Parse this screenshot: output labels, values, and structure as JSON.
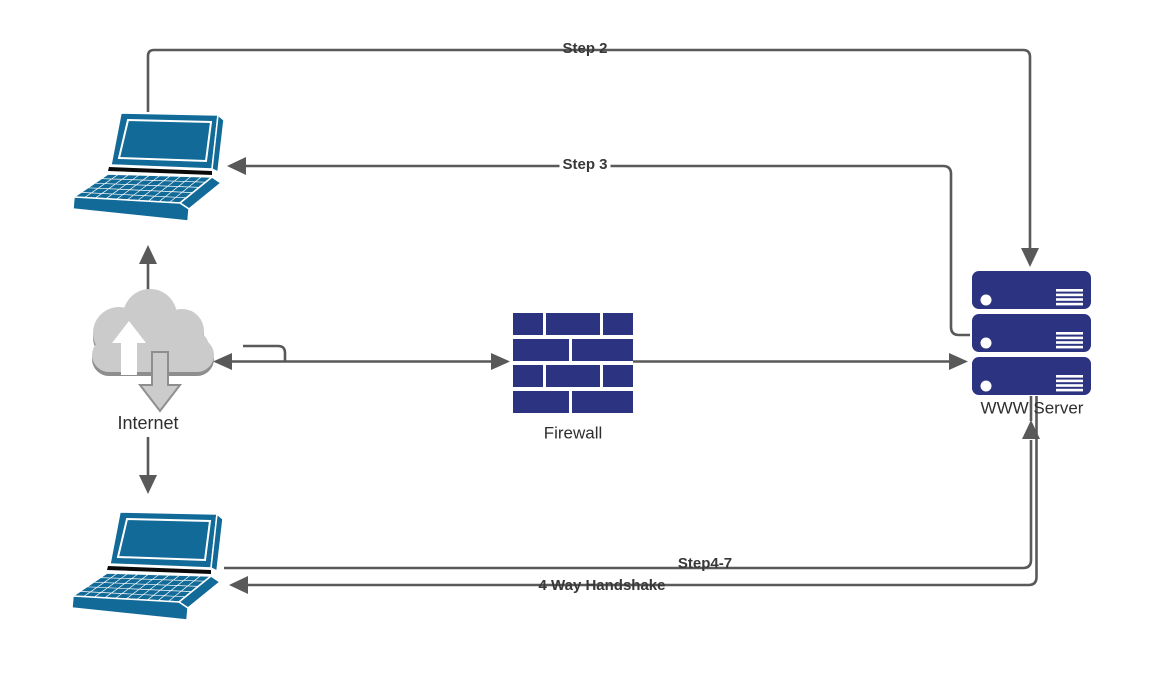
{
  "canvas": {
    "width": 1163,
    "height": 695,
    "background": "#ffffff"
  },
  "colors": {
    "device_blue": "#116A97",
    "brick_navy": "#2C3380",
    "connector_gray": "#595959",
    "cloud_gray": "#CBCBCB",
    "cloud_shadow_gray": "#8E8E8E",
    "label_text": "#2E2E2E"
  },
  "nodes": {
    "client_top": {
      "icon": "laptop-icon"
    },
    "internet": {
      "icon": "cloud-arrows-icon",
      "label": "Internet"
    },
    "firewall": {
      "icon": "firewall-bricks-icon",
      "label": "Firewall"
    },
    "www_server": {
      "icon": "server-stack-icon",
      "label": "WWW Server"
    },
    "client_bottom": {
      "icon": "laptop-icon"
    }
  },
  "connectors": {
    "step2": {
      "label": "Step 2",
      "from": "client_top",
      "to": "www_server",
      "arrowhead": "down-into-top-server"
    },
    "step3": {
      "label": "Step 3",
      "from": "www_server",
      "to": "client_top",
      "arrowhead": "left-into-laptop"
    },
    "internet_to_client_top": {
      "label": "",
      "from": "internet",
      "to": "client_top",
      "arrowhead": "up"
    },
    "internet_to_client_bottom": {
      "label": "",
      "from": "internet",
      "to": "client_bottom",
      "arrowhead": "down"
    },
    "internet_firewall": {
      "label": "",
      "from": "internet",
      "to": "firewall",
      "arrowhead": "both-ends"
    },
    "firewall_to_server": {
      "label": "",
      "from": "firewall",
      "to": "www_server",
      "arrowhead": "right-into-bottom-server"
    },
    "step4_7": {
      "label": "Step4-7",
      "from": "client_bottom",
      "to": "www_server",
      "arrowhead": "up-into-server-bottom"
    },
    "handshake": {
      "label": "4 Way Handshake",
      "from": "www_server",
      "to": "client_bottom",
      "arrowhead": "left-into-laptop"
    }
  }
}
